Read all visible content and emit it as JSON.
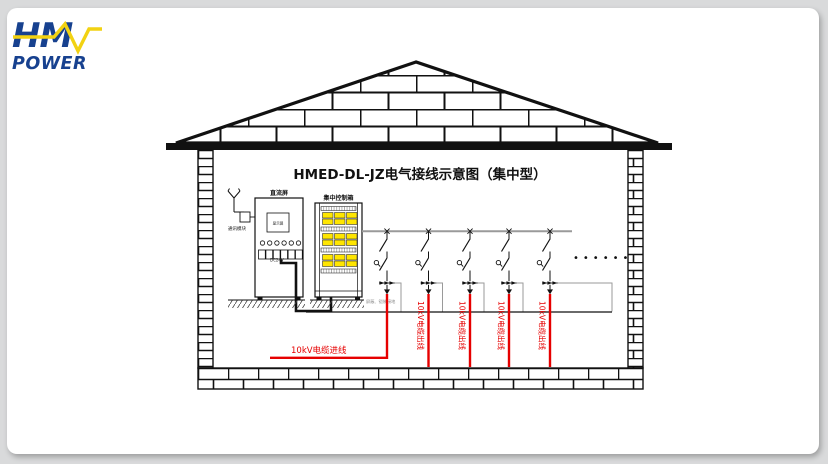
{
  "title": {
    "text": "HMED-DL-JZ电气接线示意图（集中型）"
  },
  "logo": {
    "text_top": "HM",
    "text_bottom": "POWER",
    "blue": "#17418f",
    "yellow": "#f2d212"
  },
  "labels": {
    "antenna": "通讯模块",
    "dc_panel": "直流屏",
    "dc_screen": "显示屏",
    "dc24v": "DC24V",
    "control_box": "集中控制箱",
    "ground_note": "屏蔽、铠装接地",
    "incoming": "10kV电缆进线",
    "outgoing": [
      "10kV电缆出线",
      "10kV电缆出线",
      "10kV电缆出线",
      "10kV电缆出线"
    ],
    "ellipsis": "••••••"
  },
  "colors": {
    "cable_red": "#e60000",
    "module_yellow": "#ffe600",
    "bus_gray": "#9a9a9a",
    "line_black": "#111111"
  }
}
